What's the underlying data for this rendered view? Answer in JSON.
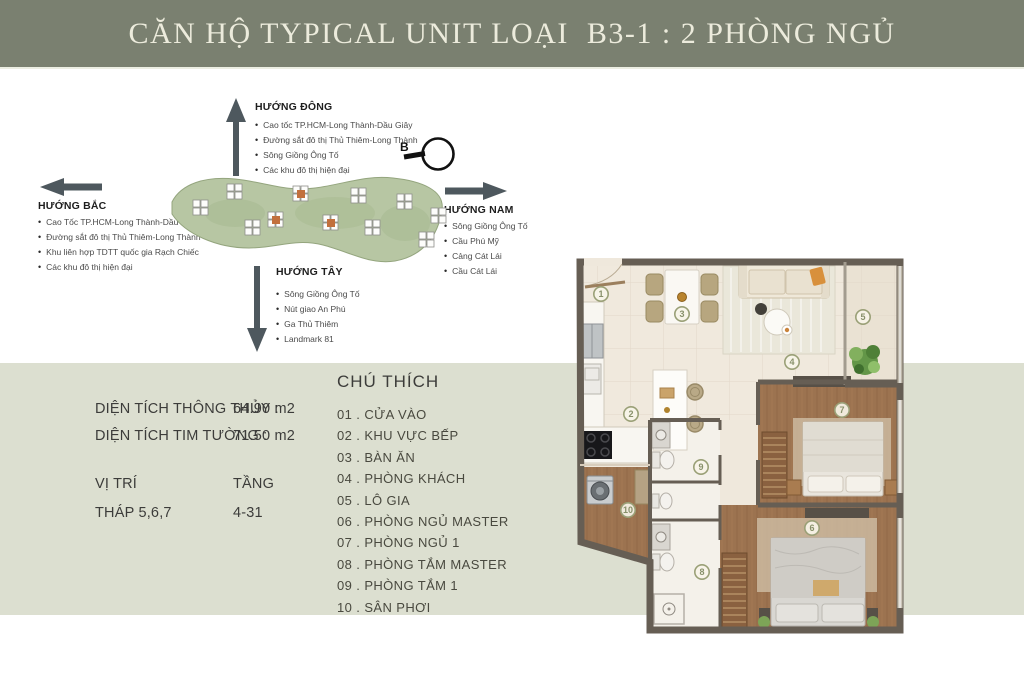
{
  "header": {
    "title": "CĂN HỘ TYPICAL UNIT LOẠI  B3-1 : 2 PHÒNG NGỦ"
  },
  "compass": {
    "label": "B"
  },
  "directions": {
    "east": {
      "label": "HƯỚNG ĐÔNG",
      "items": [
        "Cao tốc TP.HCM-Long Thành-Dầu Giây",
        "Đường sắt đô thị Thủ Thiêm-Long Thành",
        "Sông Giồng Ông Tố",
        "Các khu đô thị hiện đại"
      ]
    },
    "north": {
      "label": "HƯỚNG BẮC",
      "items": [
        "Cao Tốc TP.HCM-Long Thành-Dầu Giây",
        "Đường sắt đô thị Thủ Thiêm-Long Thành",
        "Khu liên hợp TDTT quốc gia Rạch Chiếc",
        "Các khu đô thị hiện đại"
      ]
    },
    "south": {
      "label": "HƯỚNG NAM",
      "items": [
        "Sông Giồng Ông Tố",
        "Cầu Phú Mỹ",
        "Cảng Cát Lái",
        "Cầu Cát Lái"
      ]
    },
    "west": {
      "label": "HƯỚNG TÂY",
      "items": [
        "Sông Giồng Ông Tố",
        "Nút giao An Phú",
        "Ga Thủ Thiêm",
        "Landmark 81"
      ]
    }
  },
  "info": {
    "rows": [
      {
        "label": "DIỆN TÍCH THÔNG THỦY :",
        "value": "64.90 m2"
      },
      {
        "label": "DIỆN TÍCH TIM TƯỜNG   :",
        "value": "71.50 m2"
      }
    ],
    "position_label": "VỊ TRÍ",
    "floor_label": "TẦNG",
    "position_value": "THÁP 5,6,7",
    "floor_value": "4-31"
  },
  "legend": {
    "title": "CHÚ THÍCH",
    "sep": " . ",
    "items": [
      {
        "num": "01",
        "label": "CỬA VÀO"
      },
      {
        "num": "02",
        "label": "KHU VỰC BẾP"
      },
      {
        "num": "03",
        "label": "BÀN ĂN"
      },
      {
        "num": "04",
        "label": "PHÒNG KHÁCH"
      },
      {
        "num": "05",
        "label": "LÔ GIA"
      },
      {
        "num": "06",
        "label": "PHÒNG NGỦ MASTER"
      },
      {
        "num": "07",
        "label": "PHÒNG NGỦ 1"
      },
      {
        "num": "08",
        "label": "PHÒNG TẮM MASTER"
      },
      {
        "num": "09",
        "label": "PHÒNG TẮM 1"
      },
      {
        "num": "10",
        "label": "SÂN PHƠI"
      }
    ]
  },
  "floorplan": {
    "badges": [
      "1",
      "2",
      "3",
      "4",
      "5",
      "6",
      "7",
      "8",
      "9",
      "10"
    ]
  },
  "colors": {
    "header_bg": "#7a8070",
    "header_text": "#ecebdc",
    "sage_band": "#dcdfd0",
    "arrow": "#4e585e",
    "wall": "#665e54",
    "wood_floor": "#9c7350",
    "cream_floor": "#f0e9dd",
    "badge_ring": "#9aa077",
    "site_green": "#b7c6a3",
    "tower_highlight": "#c2703d"
  }
}
